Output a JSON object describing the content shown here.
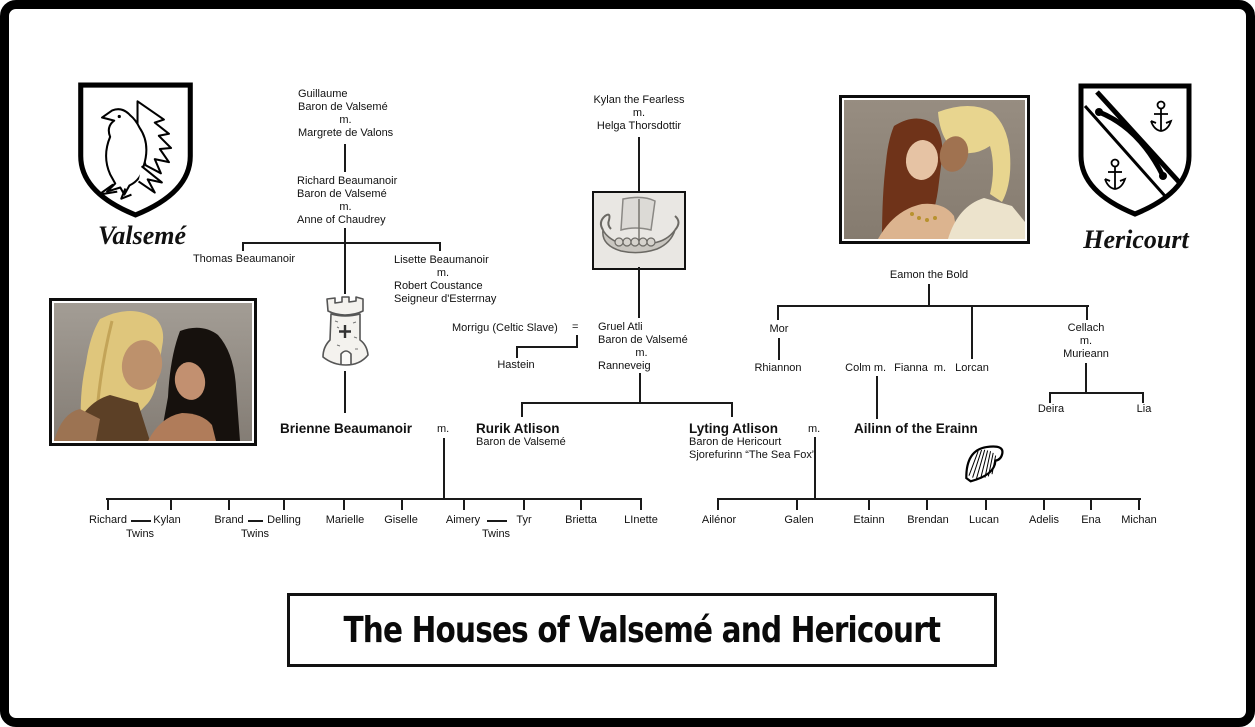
{
  "title": "The Houses of Valsemé and Hericourt",
  "houses": {
    "left": "Valsemé",
    "right": "Hericourt"
  },
  "colors": {
    "line": "#1a1a1a",
    "text": "#111111",
    "background": "#ffffff"
  },
  "icons": {
    "left_shield": "raven-crest-shield",
    "right_shield": "bow-and-anchors-shield",
    "tower": "castle-tower",
    "ship": "viking-longship",
    "harp": "celtic-harp"
  },
  "images": {
    "left_photo": "blond man and dark-haired woman",
    "right_photo": "red-haired woman and blond man"
  },
  "nodes": {
    "m": "m.",
    "equals_sign": "=",
    "guillaume": [
      "Guillaume",
      "Baron de Valsemé",
      "m.",
      "Margrete de Valons"
    ],
    "richard_sr": [
      "Richard Beaumanoir",
      "Baron de Valsemé",
      "m.",
      "Anne of Chaudrey"
    ],
    "thomas": "Thomas Beaumanoir",
    "lisette": [
      "Lisette Beaumanoir",
      "m.",
      "Robert Coustance",
      "Seigneur d'Esterrnay"
    ],
    "brienne": "Brienne Beaumanoir",
    "kylan_sr": [
      "Kylan the Fearless",
      "m.",
      "Helga Thorsdottir"
    ],
    "morrigu": "Morrigu (Celtic Slave)",
    "gruel": [
      "Gruel Atli",
      "Baron de Valsemé",
      "m.",
      "Ranneveig"
    ],
    "hastein": "Hastein",
    "rurik": [
      "Rurik Atlison",
      "Baron de Valsemé"
    ],
    "lyting": [
      "Lyting Atlison",
      "Baron de Hericourt",
      "Sjorefurinn “The Sea Fox”"
    ],
    "ailinn": "Ailinn of the Erainn",
    "eamon": "Eamon the Bold",
    "mor": "Mor",
    "rhiannon": "Rhiannon",
    "colm_row": [
      "Colm",
      "m.",
      "Fianna",
      "m.",
      "Lorcan"
    ],
    "cellach": [
      "Cellach",
      "m.",
      "Murieann"
    ],
    "deira": "Deira",
    "lia": "Lia"
  },
  "children_left": [
    "Richard",
    "Kylan",
    "Brand",
    "Delling",
    "Marielle",
    "Giselle",
    "Aimery",
    "Tyr",
    "Brietta",
    "LInette"
  ],
  "children_right": [
    "Ailénor",
    "Galen",
    "Etainn",
    "Brendan",
    "Lucan",
    "Adelis",
    "Ena",
    "Michan"
  ],
  "twins_label": "Twins"
}
